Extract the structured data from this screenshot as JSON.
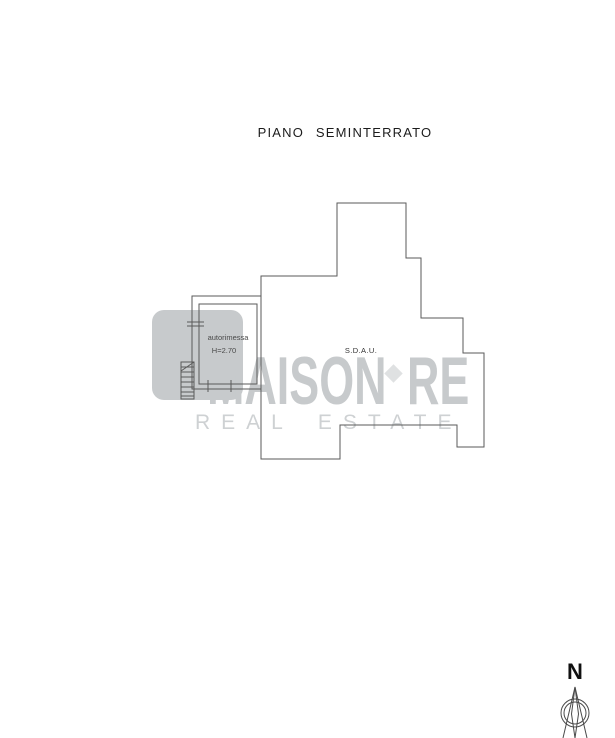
{
  "title": "PIANO SEMINTERRATO",
  "plan": {
    "line_color": "#5a5a5a",
    "labels": {
      "room_garage": "autorimessa",
      "room_garage_height": "H=2.70",
      "room_sdau": "S.D.A.U."
    }
  },
  "watermark": {
    "brand_main": "MAISON",
    "brand_suffix": "RE",
    "brand_sub": "REAL ESTATE",
    "color": "#c7cacc",
    "diamond_color": "#dfe1e2",
    "sub_color": "#ced1d3"
  },
  "compass": {
    "north_label": "N",
    "stroke_color": "#4a4a4a"
  }
}
